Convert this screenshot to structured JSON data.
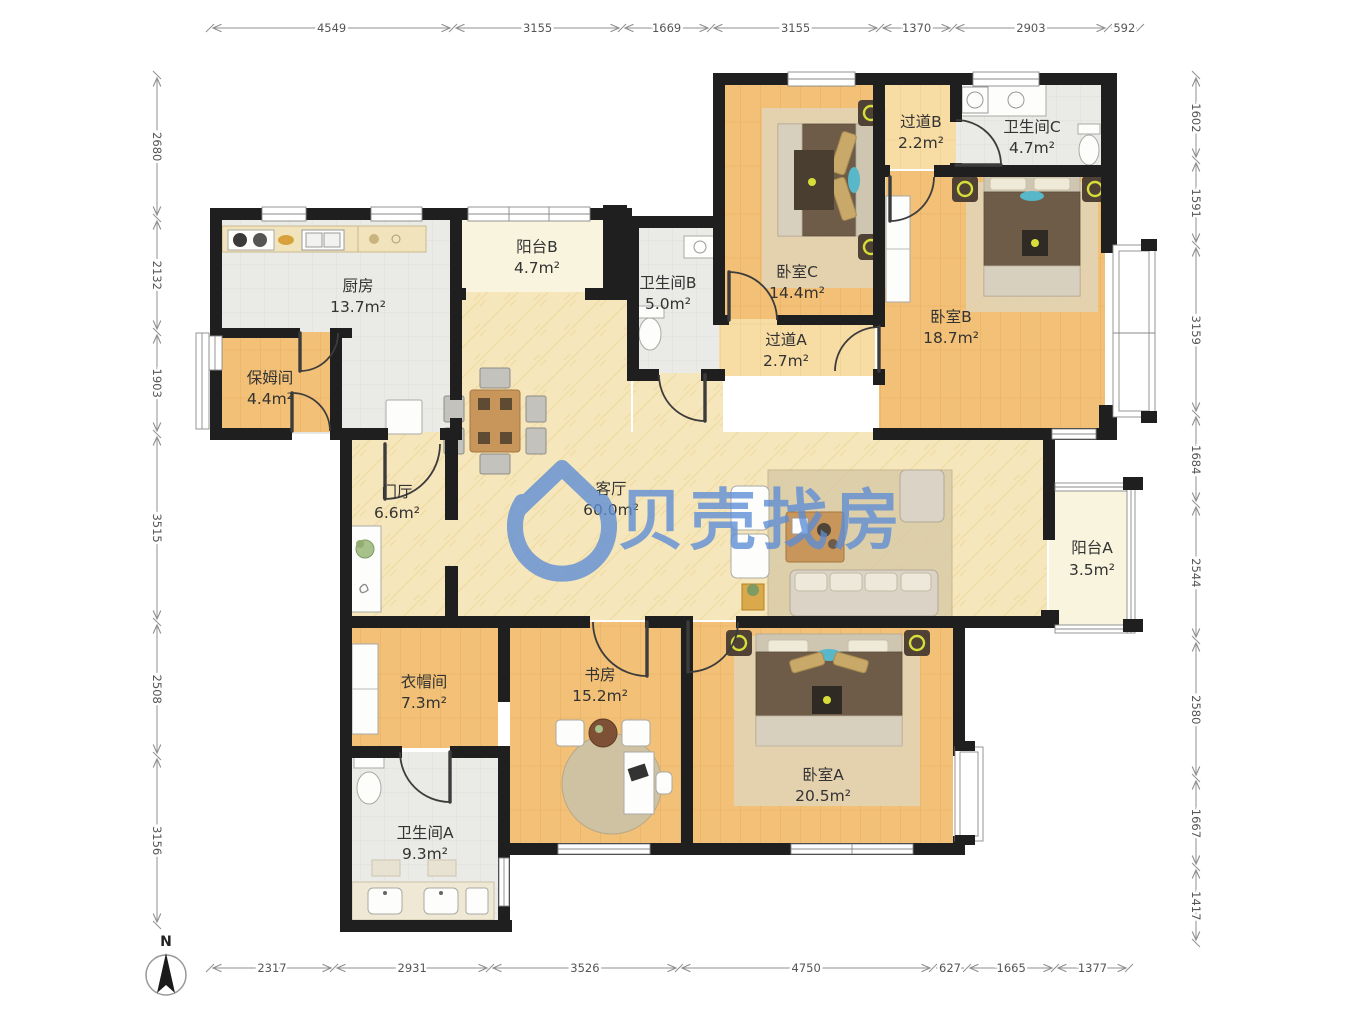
{
  "watermark": {
    "brand": "贝壳找房",
    "color": "#5C8DD6"
  },
  "compass": {
    "north_label": "N"
  },
  "rooms": {
    "kitchen": {
      "name": "厨房",
      "area": "13.7m²"
    },
    "nanny": {
      "name": "保姆间",
      "area": "4.4m²"
    },
    "balcony_b": {
      "name": "阳台B",
      "area": "4.7m²"
    },
    "bath_b": {
      "name": "卫生间B",
      "area": "5.0m²"
    },
    "bedroom_c": {
      "name": "卧室C",
      "area": "14.4m²"
    },
    "hallway_b": {
      "name": "过道B",
      "area": "2.2m²"
    },
    "bath_c": {
      "name": "卫生间C",
      "area": "4.7m²"
    },
    "bedroom_b": {
      "name": "卧室B",
      "area": "18.7m²"
    },
    "hallway_a": {
      "name": "过道A",
      "area": "2.7m²"
    },
    "foyer": {
      "name": "门厅",
      "area": "6.6m²"
    },
    "living": {
      "name": "客厅",
      "area": "60.0m²"
    },
    "balcony_a": {
      "name": "阳台A",
      "area": "3.5m²"
    },
    "cloak": {
      "name": "衣帽间",
      "area": "7.3m²"
    },
    "study": {
      "name": "书房",
      "area": "15.2m²"
    },
    "bedroom_a": {
      "name": "卧室A",
      "area": "20.5m²"
    },
    "bath_a": {
      "name": "卫生间A",
      "area": "9.3m²"
    }
  },
  "dimensions": {
    "top": [
      "4549",
      "3155",
      "1669",
      "3155",
      "1370",
      "2903",
      "592"
    ],
    "left": [
      "2680",
      "2132",
      "1903",
      "3515",
      "2508",
      "3156"
    ],
    "right": [
      "1602",
      "1591",
      "3159",
      "1684",
      "2544",
      "2580",
      "1667",
      "1417"
    ],
    "bottom": [
      "2317",
      "2931",
      "3526",
      "4750",
      "627",
      "1665",
      "1377"
    ]
  }
}
